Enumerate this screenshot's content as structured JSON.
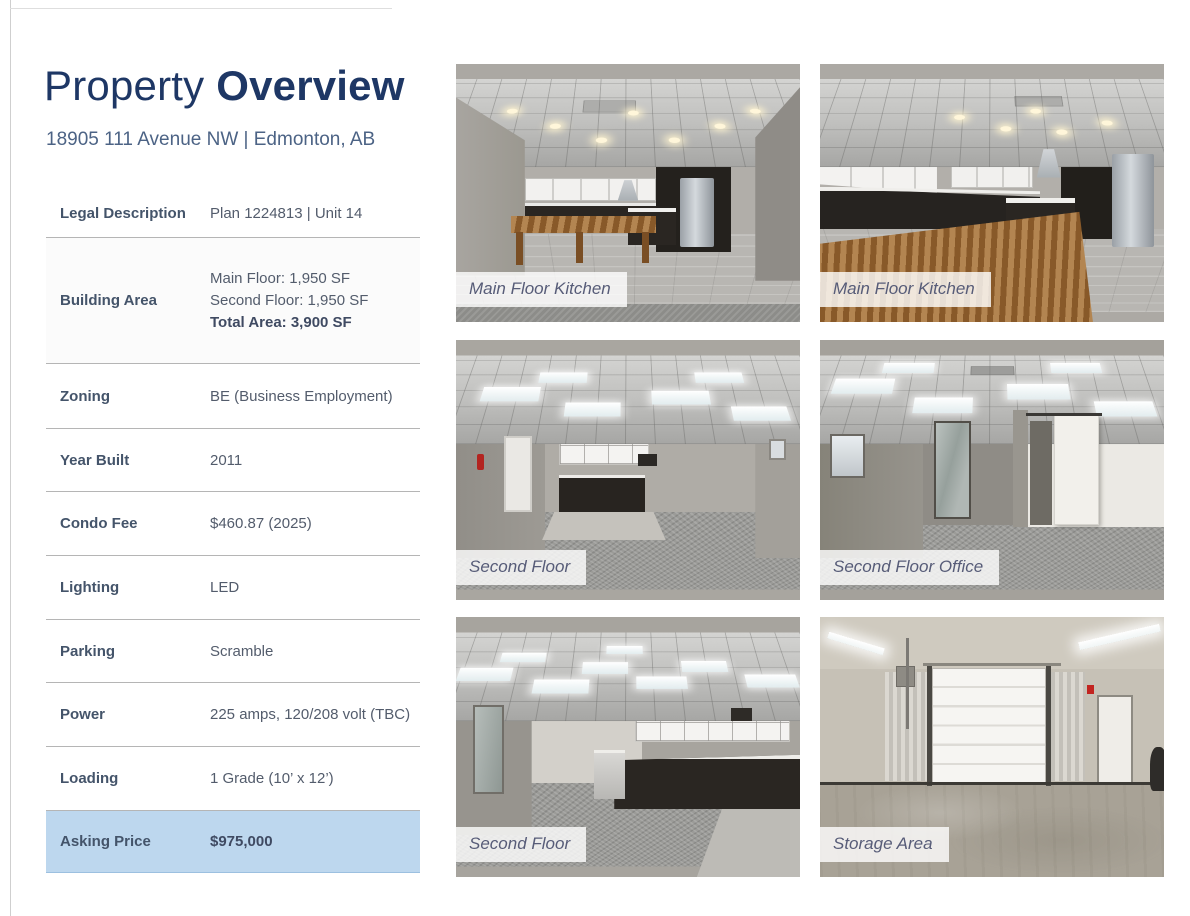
{
  "page": {
    "title_regular": "Property ",
    "title_bold": "Overview",
    "subtitle": "18905 111 Avenue NW | Edmonton, AB"
  },
  "details": {
    "rows": [
      {
        "label": "Legal Description",
        "value": "Plan 1224813 | Unit 14"
      },
      {
        "label": "Building Area",
        "lines": [
          "Main Floor: 1,950 SF",
          "Second Floor: 1,950 SF"
        ],
        "bold_line": "Total Area: 3,900 SF"
      },
      {
        "label": "Zoning",
        "value": "BE (Business Employment)"
      },
      {
        "label": "Year Built",
        "value": "2011"
      },
      {
        "label": "Condo Fee",
        "value": "$460.87 (2025)"
      },
      {
        "label": "Lighting",
        "value": "LED"
      },
      {
        "label": "Parking",
        "value": "Scramble"
      },
      {
        "label": "Power",
        "value": "225 amps, 120/208 volt (TBC)"
      },
      {
        "label": "Loading",
        "value": "1 Grade (10’ x 12’)"
      },
      {
        "label": "Asking Price",
        "value": "$975,000",
        "highlight": true
      }
    ]
  },
  "photos": [
    {
      "caption": "Main Floor Kitchen"
    },
    {
      "caption": "Main Floor Kitchen"
    },
    {
      "caption": "Second Floor"
    },
    {
      "caption": "Second Floor Office"
    },
    {
      "caption": "Second Floor"
    },
    {
      "caption": "Storage Area"
    }
  ],
  "colors": {
    "title_navy": "#1e3765",
    "subtitle_blue": "#4c6385",
    "label_slate": "#44546a",
    "value_gray": "#535c6c",
    "highlight_blue": "#bdd7ee",
    "divider_gray": "#b5b5b5",
    "caption_text": "#575c78"
  }
}
